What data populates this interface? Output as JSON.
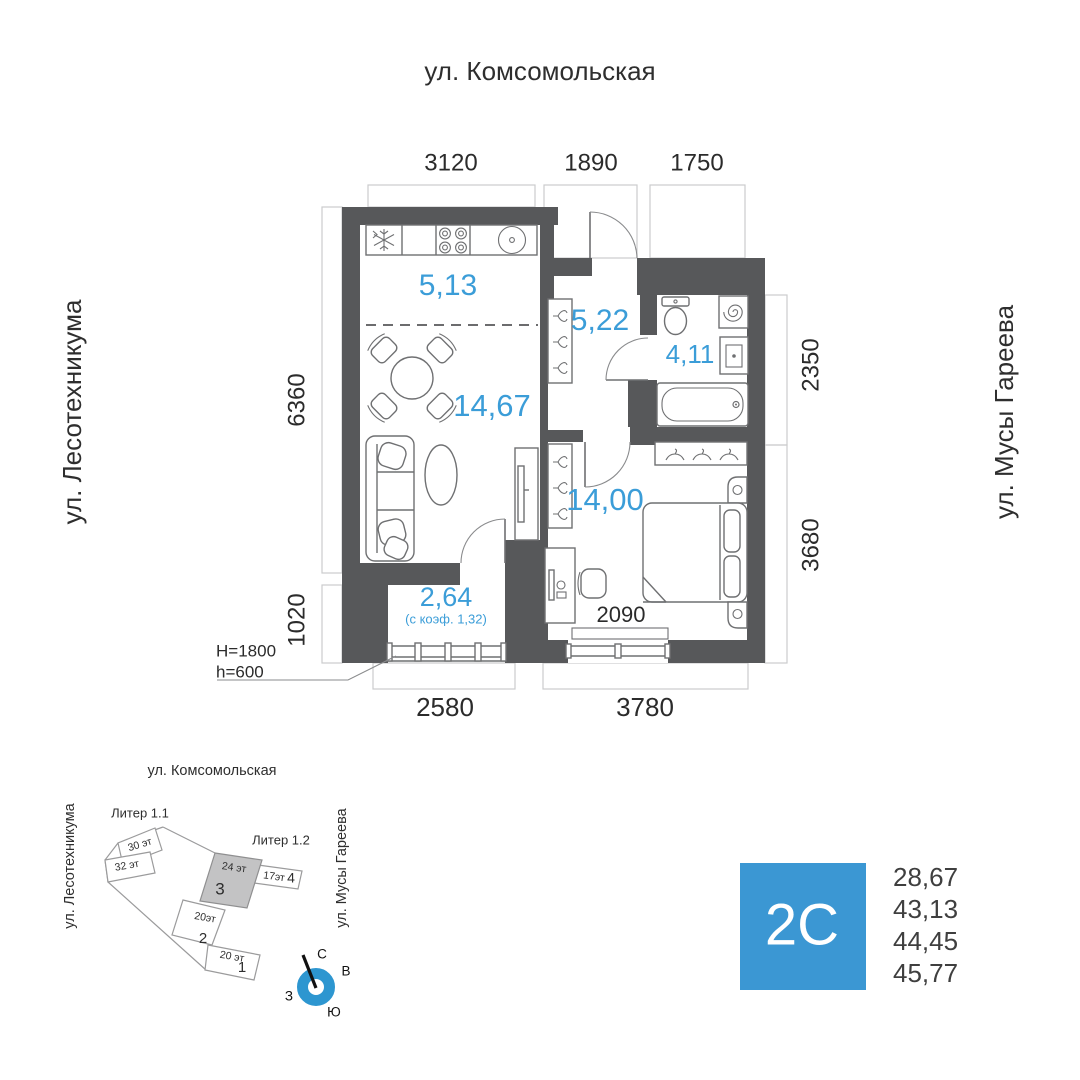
{
  "colors": {
    "accent": "#3B97D3",
    "label_blue": "#3B9DD8",
    "wall": "#57585A",
    "compass_blue": "#2D96D0"
  },
  "plan": {
    "streets": {
      "top": "ул. Комсомольская",
      "left": "ул. Лесотехникума",
      "right": "ул. Мусы Гареева"
    },
    "dimensions": {
      "top": [
        "3120",
        "1890",
        "1750"
      ],
      "left": [
        "6360",
        "1020"
      ],
      "right": [
        "2350",
        "3680"
      ],
      "bottom": [
        "2580",
        "3780"
      ],
      "bedroom_window": "2090"
    },
    "rooms": {
      "kitchen": "5,13",
      "hall": "5,22",
      "bathroom": "4,11",
      "living": "14,67",
      "bedroom": "14,00",
      "balcony": "2,64",
      "balcony_note": "(с коэф. 1,32)"
    },
    "notes": {
      "lintel": "H=1800",
      "sill": "h=600"
    }
  },
  "sitemap": {
    "streets": {
      "top": "ул. Комсомольская",
      "left": "ул. Лесотехникума",
      "right": "ул. Мусы Гареева"
    },
    "liters": [
      "Литер 1.1",
      "Литер 1.2"
    ],
    "buildings": [
      {
        "floors": "30 эт",
        "num": ""
      },
      {
        "floors": "32 эт",
        "num": ""
      },
      {
        "floors": "24 эт",
        "num": "3"
      },
      {
        "floors": "17эт",
        "num": "4"
      },
      {
        "floors": "20эт",
        "num": "2"
      },
      {
        "floors": "20 эт",
        "num": "1"
      }
    ],
    "compass": {
      "n": "С",
      "e": "В",
      "w": "З",
      "s": "Ю"
    }
  },
  "unit": {
    "code": "2C",
    "areas": [
      "28,67",
      "43,13",
      "44,45",
      "45,77"
    ]
  }
}
